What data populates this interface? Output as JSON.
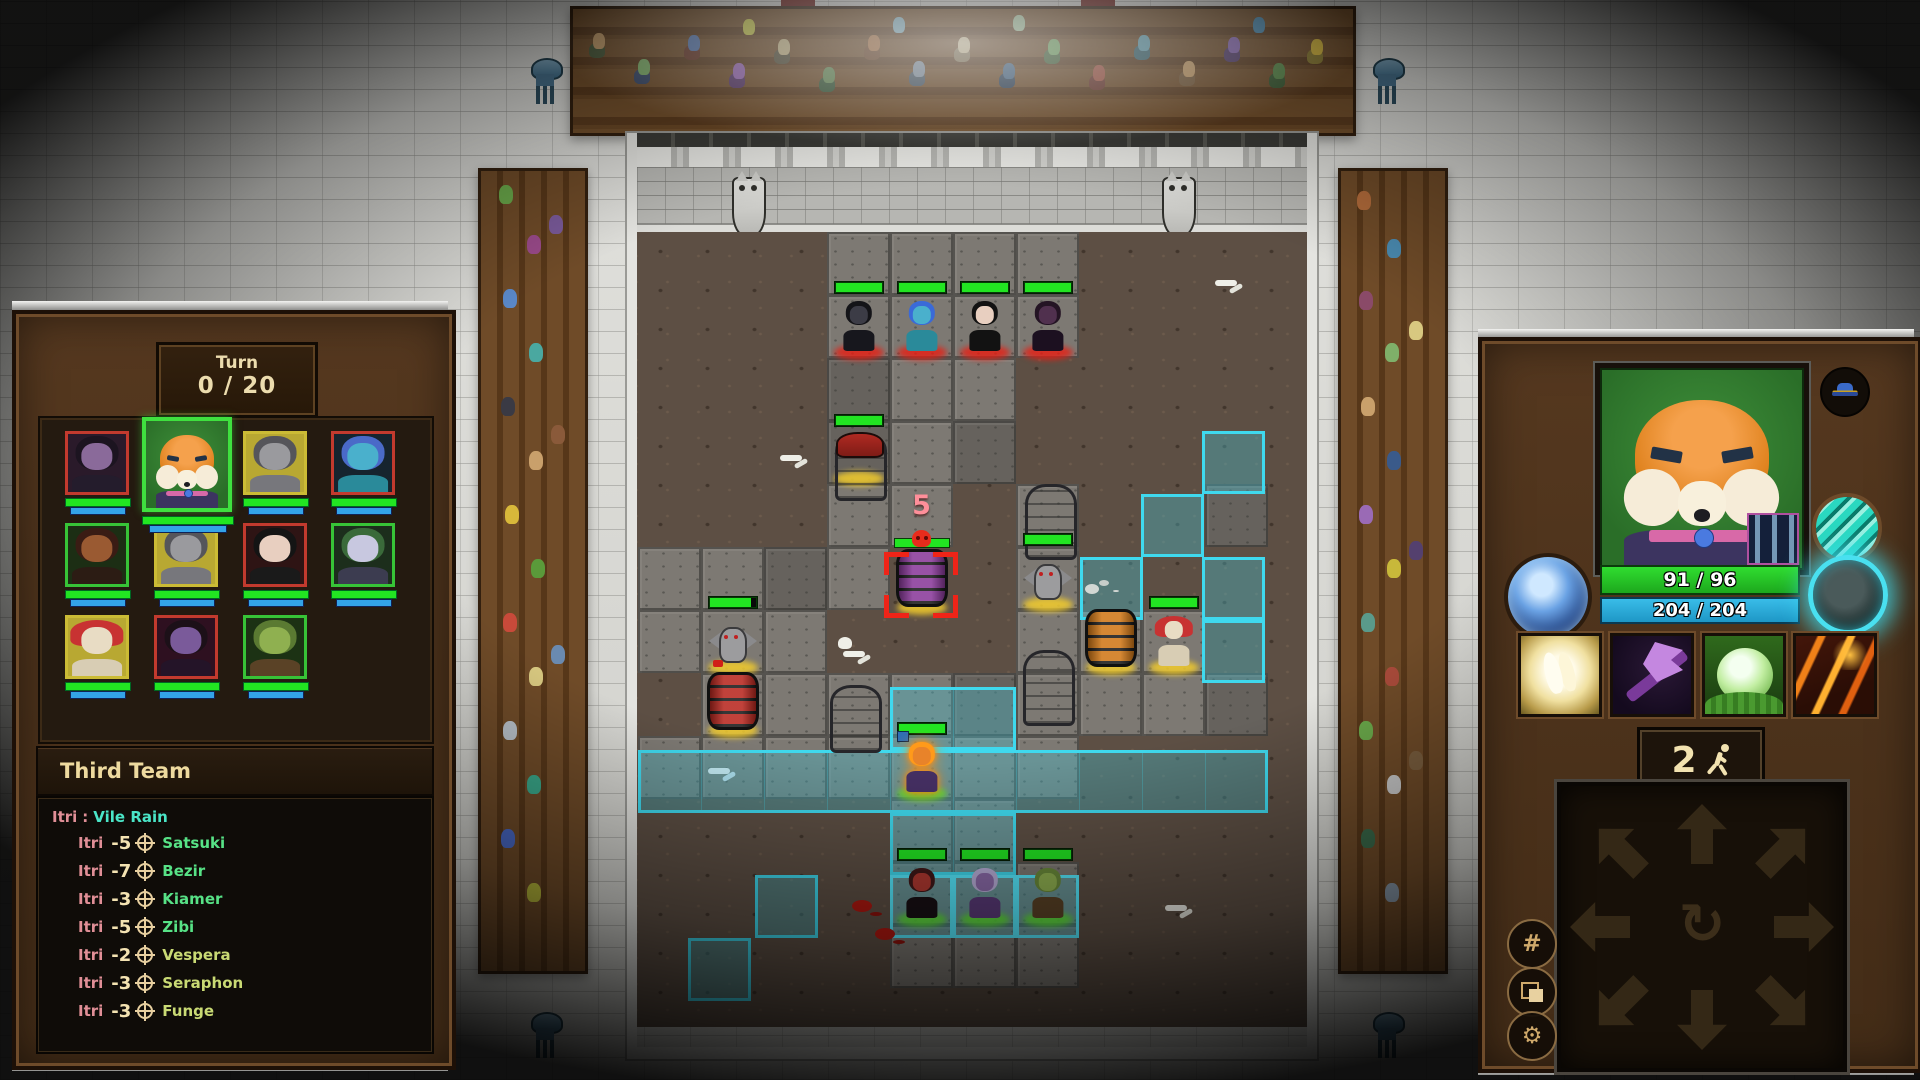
{
  "left_panel": {
    "turn": {
      "label": "Turn",
      "value": "0 / 20"
    },
    "roster": [
      {
        "name": "purple-cat-woman",
        "frame": "red"
      },
      {
        "name": "fox-hero",
        "frame": "green",
        "selected": true
      },
      {
        "name": "gray-bat",
        "frame": "yellow"
      },
      {
        "name": "blue-troll-woman",
        "frame": "red"
      },
      {
        "name": "horned-dark-elf",
        "frame": "green"
      },
      {
        "name": "gray-bat-2",
        "frame": "yellow"
      },
      {
        "name": "black-haired-woman",
        "frame": "red"
      },
      {
        "name": "pale-elf",
        "frame": "green"
      },
      {
        "name": "mushroom-man",
        "frame": "yellow"
      },
      {
        "name": "purple-demon",
        "frame": "red"
      },
      {
        "name": "green-orc",
        "frame": "green"
      }
    ],
    "team_header": "Third Team",
    "log": {
      "cast": {
        "actor": "Itri",
        "separator": ":",
        "ability": "Vile Rain"
      },
      "entries": [
        {
          "actor": "Itri",
          "amount": "-5",
          "target": "Satsuki",
          "tone": "bright"
        },
        {
          "actor": "Itri",
          "amount": "-7",
          "target": "Bezir",
          "tone": "bright"
        },
        {
          "actor": "Itri",
          "amount": "-3",
          "target": "Kiamer",
          "tone": "bright"
        },
        {
          "actor": "Itri",
          "amount": "-5",
          "target": "Zibi",
          "tone": "bright"
        },
        {
          "actor": "Itri",
          "amount": "-2",
          "target": "Vespera",
          "tone": "olive"
        },
        {
          "actor": "Itri",
          "amount": "-3",
          "target": "Seraphon",
          "tone": "olive"
        },
        {
          "actor": "Itri",
          "amount": "-3",
          "target": "Funge",
          "tone": "olive"
        }
      ]
    }
  },
  "arena": {
    "damage_preview": "5",
    "selected_target": "purple-barrel",
    "enemy_units": [
      "shadow-cat",
      "blue-troll-woman",
      "black-haired-woman",
      "purple-demon-cat"
    ],
    "neutral_units": [
      "red-cap-statue",
      "gargoyle-left",
      "gargoyle-center",
      "mushroom-man"
    ],
    "objects": [
      "purple-barrel",
      "orange-barrel",
      "red-barrel",
      "tombstone",
      "stone-pillar"
    ],
    "ally_units": [
      "fox-hero",
      "red-demon-woman",
      "purple-troll-mage",
      "green-orc"
    ]
  },
  "right_panel": {
    "portrait": "fox-hero",
    "hp_text": "91 / 96",
    "shield_text": "204 / 204",
    "moves_value": "2",
    "abilities": [
      "healing-hands",
      "shadow-axe",
      "life-sphere",
      "eruption"
    ],
    "orbs": [
      "spirit-orb",
      "striped-shield-orb",
      "cyan-ring-orb"
    ],
    "equipment": [
      "blue-hat"
    ],
    "controls": [
      "grid",
      "layers",
      "settings"
    ]
  },
  "colors": {
    "hp_green": "#22e522",
    "shield_blue": "#2fb9e8",
    "highlight_cyan": "#3fd9ee",
    "target_red": "#ef2418",
    "log_actor": "#e18f97",
    "log_ability": "#4ae5c7",
    "log_amount": "#f4e3b2",
    "name_bright": "#57e286",
    "name_olive": "#c9da74",
    "plaque_text": "#ecdcae"
  }
}
